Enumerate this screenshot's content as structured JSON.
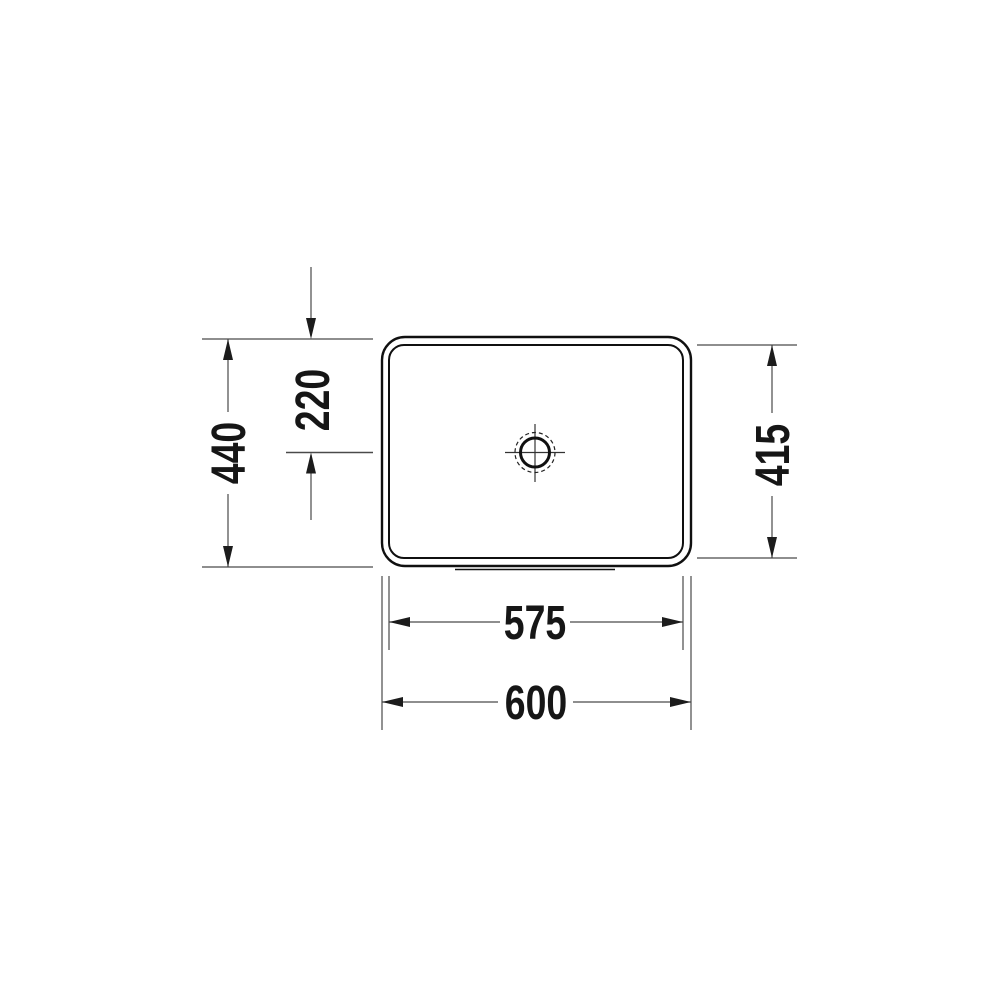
{
  "diagram": {
    "title": "washbasin-top-view-dimension-drawing",
    "dimensions": {
      "overall_width": "600",
      "inner_width": "575",
      "overall_depth": "440",
      "inner_depth": "415",
      "drain_offset_from_top": "220"
    },
    "units_shown": false,
    "colors": {
      "background": "#ffffff",
      "outline_ink": "#101010",
      "dimension_line": "#4a4a4a",
      "text_ink": "#161616"
    }
  }
}
